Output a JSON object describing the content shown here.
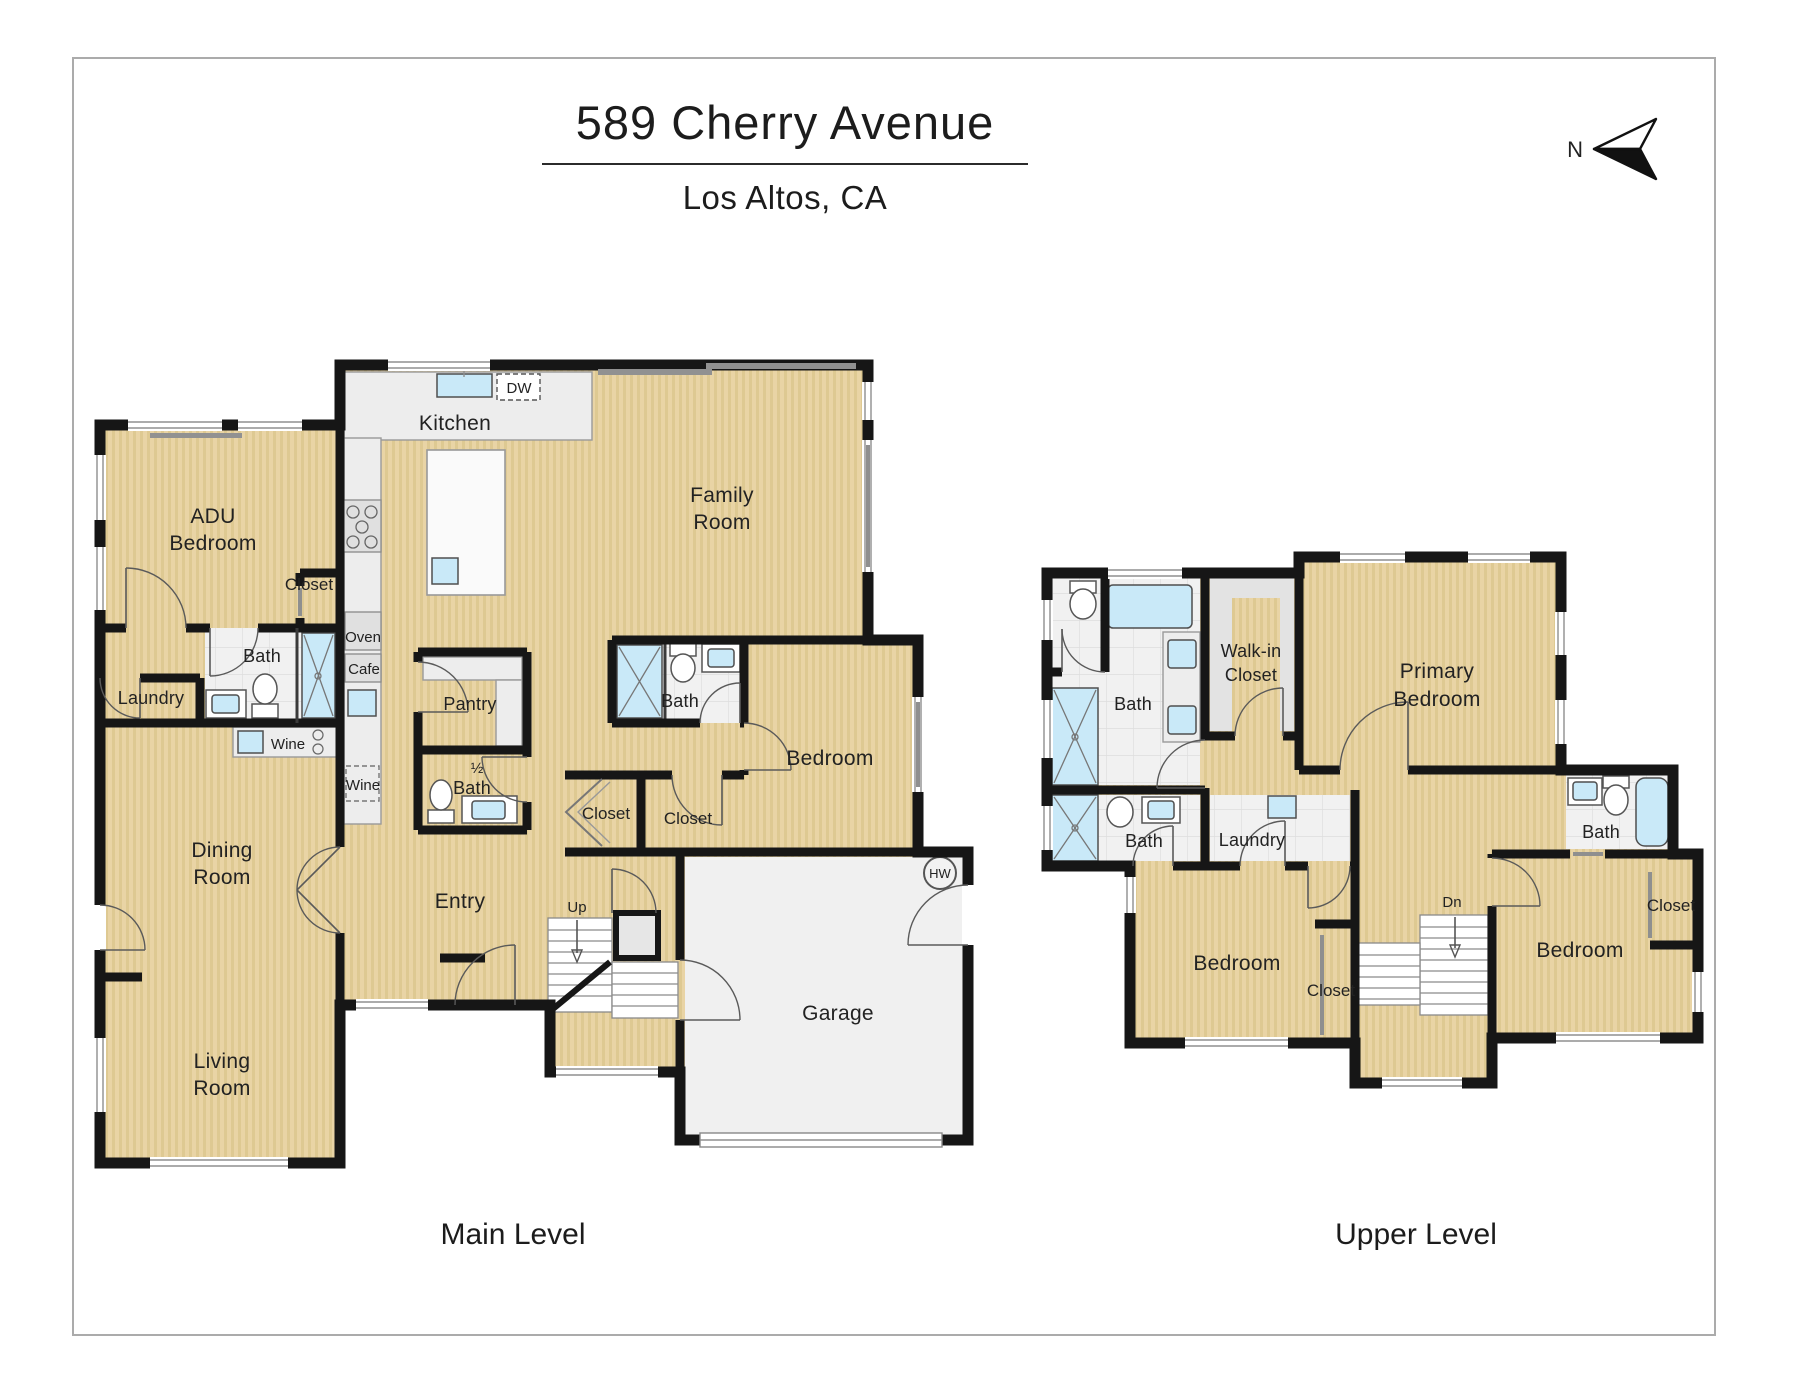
{
  "header": {
    "title": "589 Cherry Avenue",
    "subtitle": "Los Altos, CA",
    "north": "N"
  },
  "captions": {
    "main": "Main Level",
    "upper": "Upper Level"
  },
  "colors": {
    "floor_tan": "#e9d4a5",
    "floor_stripe": "#dec992",
    "wall_black": "#161616",
    "tile_white": "#f1f1f1",
    "fixture_blue": "#c9e9f8",
    "garage_gray": "#f0f0f0",
    "closet_gray": "#e3e3e3"
  },
  "main_level": {
    "labels": {
      "kitchen": "Kitchen",
      "family1": "Family",
      "family2": "Room",
      "adu1": "ADU",
      "adu2": "Bedroom",
      "adu_closet": "Closet",
      "adu_bath": "Bath",
      "laundry": "Laundry",
      "adu_wine": "Wine",
      "oven": "Oven",
      "cafe": "Cafe",
      "kitchen_wine": "Wine",
      "dw": "DW",
      "pantry": "Pantry",
      "half1": "½",
      "half2": "Bath",
      "suite_bath": "Bath",
      "hall_closet": "Closet",
      "bedroom_closet": "Closet",
      "bedroom": "Bedroom",
      "dining1": "Dining",
      "dining2": "Room",
      "entry": "Entry",
      "up": "Up",
      "living1": "Living",
      "living2": "Room",
      "garage": "Garage",
      "hw": "HW"
    }
  },
  "upper_level": {
    "labels": {
      "bath_primary": "Bath",
      "walkin1": "Walk-in",
      "walkin2": "Closet",
      "primary1": "Primary",
      "primary2": "Bedroom",
      "bath2": "Bath",
      "laundry": "Laundry",
      "bath_right": "Bath",
      "bedroom_left": "Bedroom",
      "closet_left": "Closet",
      "dn": "Dn",
      "bedroom_right": "Bedroom",
      "closet_right": "Closet"
    }
  }
}
